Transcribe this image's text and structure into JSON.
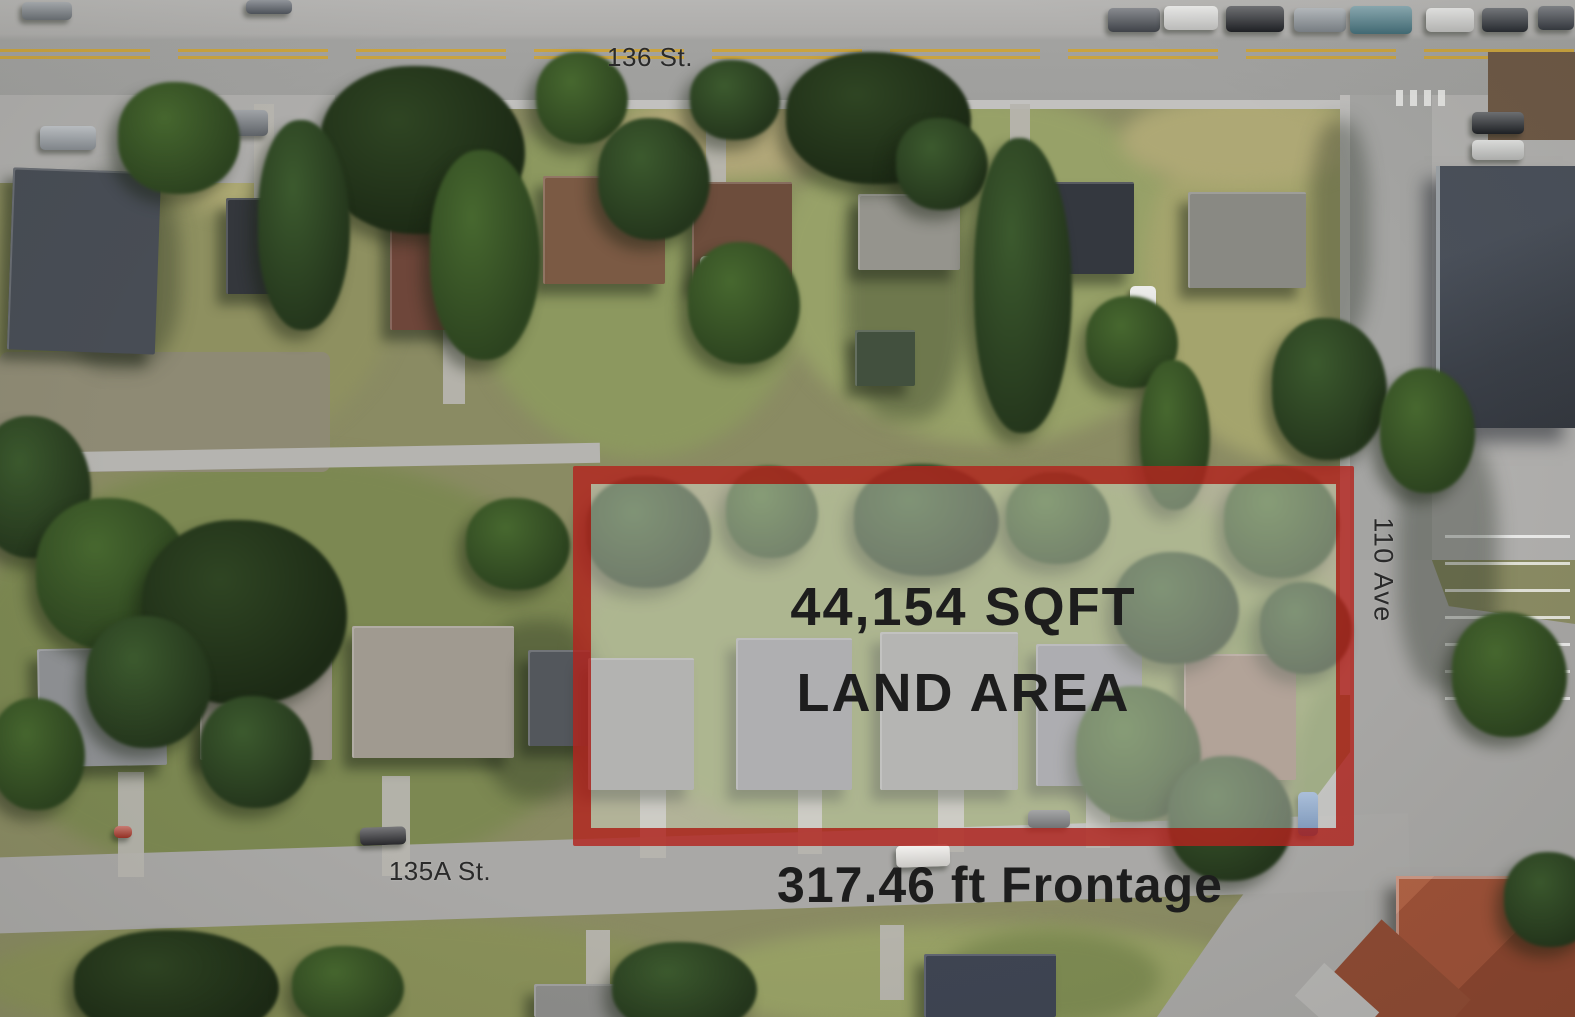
{
  "streets": {
    "top": "136 St.",
    "right": "110 Ave",
    "bottom": "135A St."
  },
  "property": {
    "land_area_line1": "44,154 SQFT",
    "land_area_line2": "LAND AREA",
    "frontage": "317.46 ft Frontage"
  },
  "colors": {
    "boundary_red": "#b2251e",
    "annotation_text": "#1d1d1d",
    "street_label_text": "#2a2a2a"
  }
}
